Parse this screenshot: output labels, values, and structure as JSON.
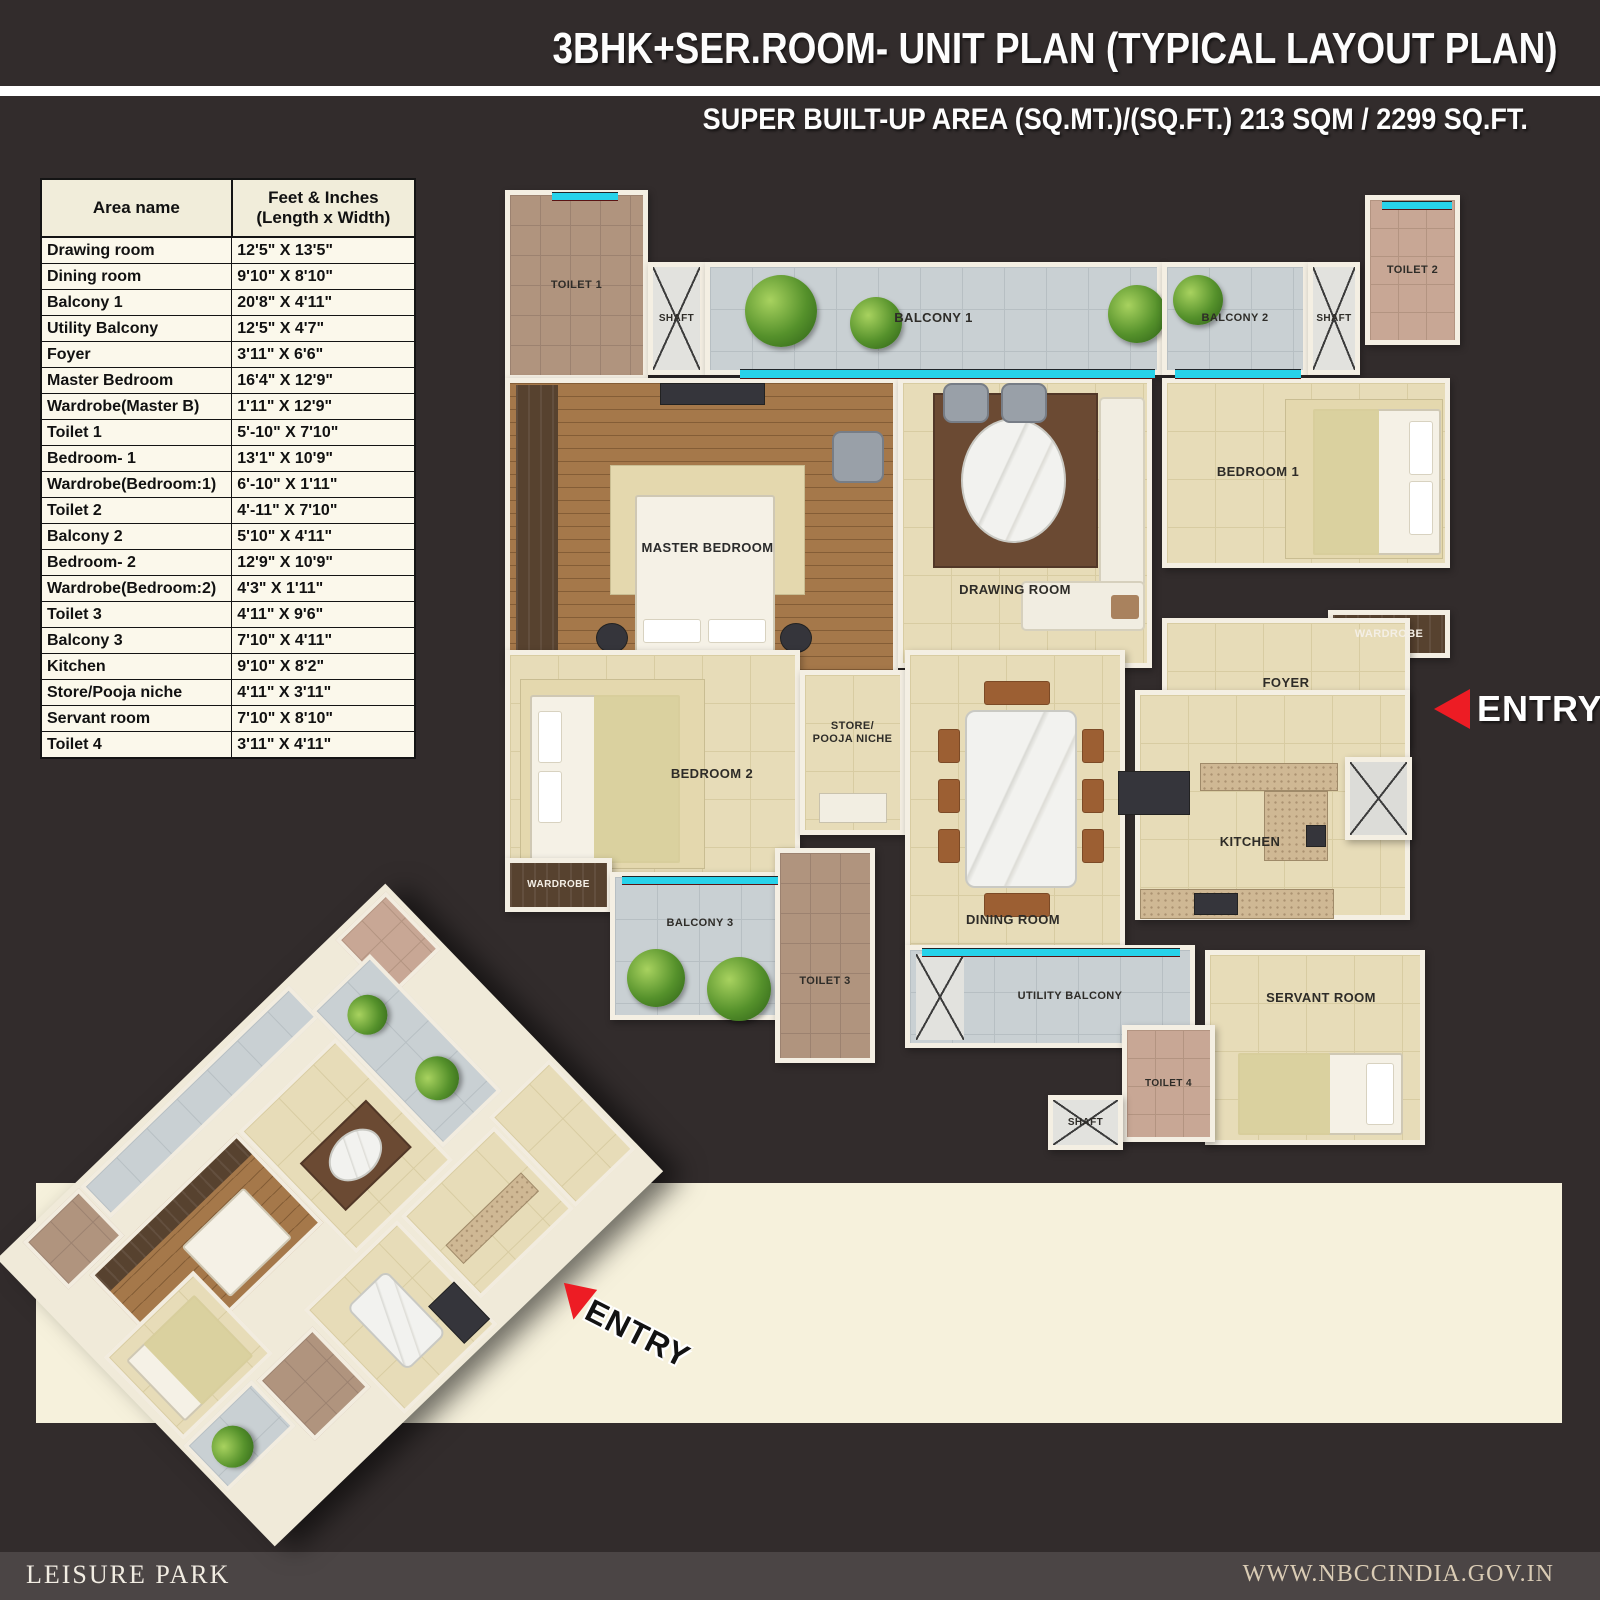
{
  "header": {
    "title": "3BHK+SER.ROOM- UNIT PLAN (TYPICAL LAYOUT PLAN)",
    "subtitle": "SUPER BUILT-UP AREA (SQ.MT.)/(SQ.FT.) 213 SQM / 2299 SQ.FT."
  },
  "dimensions_table": {
    "col1_header": "Area name",
    "col2_header_line1": "Feet & Inches",
    "col2_header_line2": "(Length x Width)",
    "rows": [
      {
        "area": "Drawing room",
        "size": "12'5\" X 13'5\""
      },
      {
        "area": "Dining room",
        "size": "9'10\" X 8'10\""
      },
      {
        "area": "Balcony 1",
        "size": "20'8\" X 4'11\""
      },
      {
        "area": "Utility Balcony",
        "size": "12'5\" X 4'7\""
      },
      {
        "area": "Foyer",
        "size": "3'11\" X 6'6\""
      },
      {
        "area": "Master Bedroom",
        "size": "16'4\" X 12'9\""
      },
      {
        "area": "Wardrobe(Master B)",
        "size": "1'11\" X 12'9\""
      },
      {
        "area": "Toilet 1",
        "size": "5'-10\" X 7'10\""
      },
      {
        "area": "Bedroom- 1",
        "size": "13'1\" X 10'9\""
      },
      {
        "area": "Wardrobe(Bedroom:1)",
        "size": "6'-10\" X 1'11\""
      },
      {
        "area": "Toilet 2",
        "size": "4'-11\" X 7'10\""
      },
      {
        "area": "Balcony 2",
        "size": "5'10\" X 4'11\""
      },
      {
        "area": "Bedroom- 2",
        "size": "12'9\" X 10'9\""
      },
      {
        "area": "Wardrobe(Bedroom:2)",
        "size": "4'3\" X 1'11\""
      },
      {
        "area": "Toilet 3",
        "size": "4'11\" X 9'6\""
      },
      {
        "area": "Balcony 3",
        "size": "7'10\" X 4'11\""
      },
      {
        "area": "Kitchen",
        "size": "9'10\" X 8'2\""
      },
      {
        "area": "Store/Pooja niche",
        "size": "4'11\" X 3'11\""
      },
      {
        "area": "Servant room",
        "size": "7'10\" X 8'10\""
      },
      {
        "area": "Toilet 4",
        "size": "3'11\" X 4'11\""
      }
    ]
  },
  "floor_plan": {
    "labels": {
      "toilet_1": "TOILET 1",
      "shaft_top_left": "SHAFT",
      "balcony_1": "BALCONY 1",
      "balcony_2": "BALCONY 2",
      "shaft_top_right": "SHAFT",
      "toilet_2": "TOILET 2",
      "master_bedroom": "MASTER BEDROOM",
      "drawing_room": "DRAWING ROOM",
      "bedroom_1": "BEDROOM 1",
      "wardrobe_bedroom_1": "WARDROBE",
      "foyer": "FOYER",
      "bedroom_2": "BEDROOM 2",
      "wardrobe_bedroom_2": "WARDROBE",
      "store_line1": "STORE/",
      "store_line2": "POOJA NICHE",
      "balcony_3": "BALCONY 3",
      "toilet_3": "TOILET 3",
      "dining_room": "DINING ROOM",
      "kitchen": "KITCHEN",
      "utility_balcony": "UTILITY BALCONY",
      "servant_room": "SERVANT ROOM",
      "toilet_4": "TOILET 4",
      "shaft_bottom": "SHAFT"
    },
    "entry_label": "ENTRY"
  },
  "iso_plan": {
    "entry_label": "ENTRY"
  },
  "footer": {
    "project_name": "LEISURE PARK",
    "website": "WWW.NBCCINDIA.GOV.IN"
  },
  "colors": {
    "background": "#322c2c",
    "accent_red": "#ed1c24",
    "window_cyan": "#27d2ea",
    "panel_cream": "#f6f1dc",
    "wall_white": "#f4efe3",
    "floor_beige": "#e7dcb8",
    "floor_wood": "#a5784a",
    "balcony_gray": "#c9d0d3",
    "wardrobe_dark": "#57422f",
    "footer_bar": "#4b4545"
  }
}
